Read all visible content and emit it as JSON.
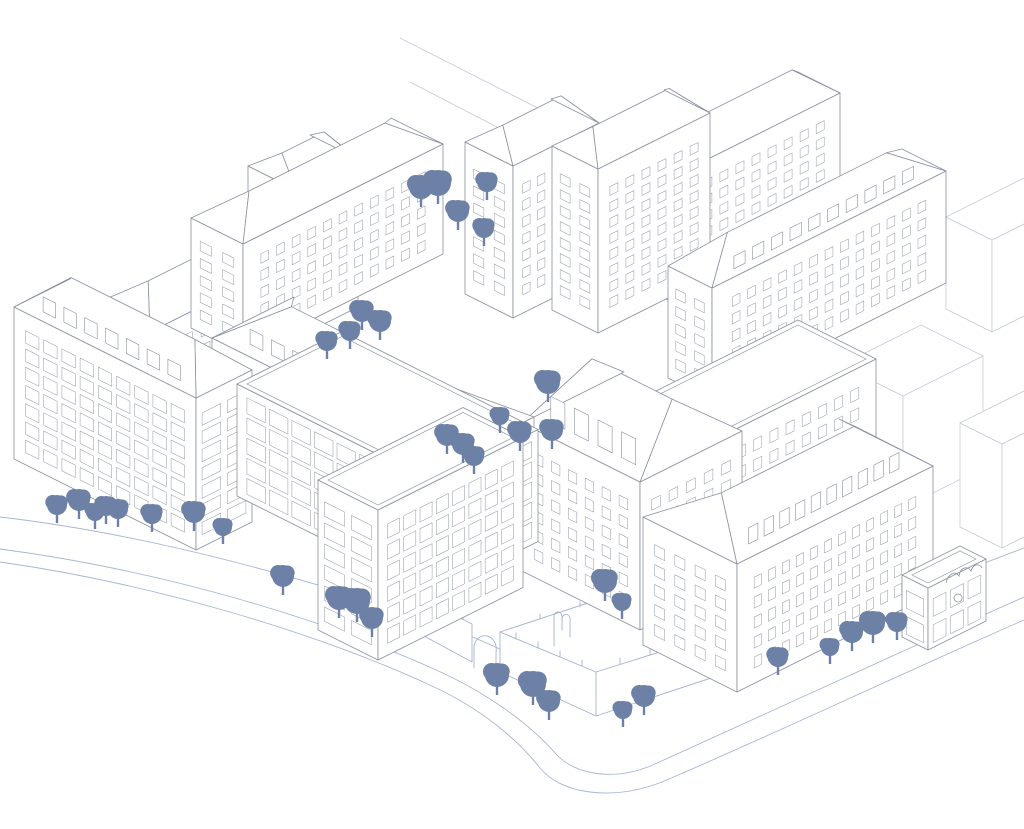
{
  "illustration": {
    "type": "axonometric-line-drawing",
    "subject": "urban block massing illustration with buildings, ruin walls, streets and trees",
    "background": "#ffffff"
  },
  "colors": {
    "line": "#8a90a0",
    "window": "#9aa0ad",
    "ghost": "#c7cdd9",
    "road": "#a9b5d6",
    "ruin": "#a4b1d3",
    "tree": "#6d80a6",
    "fill": "#ffffff"
  },
  "scene": {
    "context_lines": [
      "M 400,38 L 585,132",
      "M 410,82 L 522,140"
    ],
    "roads": [
      "M 0,517 C 130,532 270,568 405,612 C 450,627 492,644 526,662",
      "M 526,662 C 560,681 600,700 640,694 L 1024,548",
      "M 0,549 C 160,570 320,618 434,669 C 486,692 530,724 556,754 C 575,775 615,782 655,764 C 760,716 900,652 1024,597",
      "M 0,562 C 162,585 324,636 432,686 C 482,709 518,740 540,768 C 560,793 610,802 662,782 C 770,736 905,672 1024,620"
    ],
    "ruin": {
      "walls": [
        "424,600 472,624 472,662 424,636",
        "500,632 596,672 790,611 790,652 596,716 500,672"
      ],
      "lines": [
        "M 596,672 L 596,716",
        "M 500,632 L 694,568 L 790,611",
        "M 474,668 L 474,646 A 11,13 0 0 1 496,652 L 496,678",
        "M 554,646 L 554,616 a 4,5 0 0 1 8,2 l 0,12 m 0,-12 a 4,5 0 0 1 8,3 l 0,16",
        "M 433,604 l 0,-5 M 443,609 l 0,-5 M 453,614 l 0,-5 M 463,619 l 0,-5 M 516,639 l 0,-6 M 538,648 l 0,-6 M 560,657 l 0,-6 M 582,666 l 0,-6 M 620,664 l 0,-6 M 650,655 l 0,-6 M 680,646 l 0,-6 M 710,636 l 0,-6 M 740,627 l 0,-6 M 770,617 l 0,-6 M 540,619 l 0,-5 M 580,607 l 0,-5 M 620,594 l 0,-5 M 660,582 l 0,-5 M 720,580 l 0,-5 M 752,594 l 0,-5"
      ]
    },
    "chapel_details": [
      "M 946,583 c 2,-9 9,-13 13,-7 c 1,-8 8,-11 12,-5 c 2,-7 8,-8 11,-3",
      "M 958,602 a 4,4 0 1 1 0.2,0"
    ],
    "ghost_buildings": [
      {
        "name": "context-block-northeast",
        "c": [
          992,
          332
        ],
        "a": 46,
        "b": 88,
        "h": 92,
        "roof": "flat"
      },
      {
        "name": "context-block-east-1",
        "c": [
          903,
          508
        ],
        "a": 62,
        "b": 80,
        "h": 112,
        "roof": "flat"
      },
      {
        "name": "context-block-east-2",
        "c": [
          1002,
          548
        ],
        "a": 42,
        "b": 110,
        "h": 104,
        "roof": "flat"
      }
    ],
    "buildings": [
      {
        "name": "north-back-block",
        "c": [
          672,
          302
        ],
        "a": 42,
        "b": 168,
        "h": 125,
        "roof": "hip",
        "rise": 26,
        "se": {
          "cols": 9,
          "rows": 6,
          "style": "punched"
        },
        "sw": {
          "cols": 2,
          "rows": 6,
          "style": "punched"
        }
      },
      {
        "name": "north-tower-west",
        "c": [
          513,
          318
        ],
        "a": 48,
        "b": 86,
        "h": 152,
        "roof": "hip",
        "rise": 22,
        "se": {
          "cols": 5,
          "rows": 7,
          "style": "punched"
        },
        "sw": {
          "cols": 2,
          "rows": 7,
          "style": "punched"
        }
      },
      {
        "name": "north-tower-east",
        "c": [
          598,
          333
        ],
        "a": 46,
        "b": 112,
        "h": 164,
        "roof": "hip",
        "rise": 22,
        "se": {
          "cols": 6,
          "rows": 8,
          "style": "punched"
        },
        "sw": {
          "cols": 2,
          "rows": 8,
          "style": "punched"
        }
      },
      {
        "name": "northeast-slab",
        "c": [
          712,
          400
        ],
        "a": 44,
        "b": 234,
        "h": 112,
        "roof": "hip",
        "rise": 26,
        "dormers": 10,
        "se": {
          "cols": 13,
          "rows": 5,
          "style": "punched"
        },
        "sw": {
          "cols": 2,
          "rows": 5,
          "style": "punched"
        }
      },
      {
        "name": "northwest-back-slab",
        "c": [
          150,
          452
        ],
        "a": 56,
        "b": 164,
        "h": 120,
        "roof": "hip",
        "rise": 24,
        "se": {
          "cols": 8,
          "rows": 5,
          "style": "punched"
        },
        "sw": {
          "cols": 2,
          "rows": 5,
          "style": "punched"
        }
      },
      {
        "name": "west-tower",
        "c": [
          296,
          338
        ],
        "a": 48,
        "b": 62,
        "h": 148,
        "roof": "hip",
        "rise": 20,
        "se": {
          "cols": 3,
          "rows": 7,
          "style": "punched"
        },
        "sw": {
          "cols": 2,
          "rows": 7,
          "style": "punched"
        }
      },
      {
        "name": "west-slab",
        "c": [
          243,
          354
        ],
        "a": 52,
        "b": 200,
        "h": 110,
        "roof": "hip",
        "rise": 24,
        "se": {
          "cols": 11,
          "rows": 5,
          "style": "punched"
        },
        "sw": {
          "cols": 2,
          "rows": 5,
          "style": "punched"
        }
      },
      {
        "name": "courtyard-block",
        "c": [
          688,
          558
        ],
        "a": 78,
        "b": 188,
        "h": 105,
        "roof": "flat",
        "se": {
          "cols": 10,
          "rows": 4,
          "style": "punched"
        },
        "sw": {
          "cols": 3,
          "rows": 4,
          "style": "punched"
        }
      },
      {
        "name": "center-hip-building",
        "c": [
          640,
          630
        ],
        "a": 118,
        "b": 102,
        "h": 148,
        "roof": "hip",
        "rise": 48,
        "dormers": 4,
        "sw": {
          "cols": 6,
          "rows": 6,
          "style": "punched"
        },
        "se": {
          "cols": 5,
          "rows": 6,
          "style": "punched"
        }
      },
      {
        "name": "classical-terrace",
        "c": [
          452,
          576
        ],
        "a": 240,
        "b": 82,
        "h": 118,
        "roof": "hip",
        "rise": 30,
        "dormers": 9,
        "sw": {
          "cols": 11,
          "rows": 6,
          "style": "punched"
        },
        "se": {
          "cols": 3,
          "rows": 6,
          "style": "punched"
        }
      },
      {
        "name": "southeast-building",
        "c": [
          737,
          692
        ],
        "a": 94,
        "b": 196,
        "h": 128,
        "roof": "hip",
        "rise": 32,
        "dormers": 10,
        "se": {
          "cols": 12,
          "rows": 5,
          "style": "punched"
        },
        "sw": {
          "cols": 4,
          "rows": 5,
          "style": "punched"
        }
      },
      {
        "name": "corner-chapel",
        "c": [
          928,
          650
        ],
        "a": 26,
        "b": 58,
        "h": 62,
        "roof": "flat",
        "se": {
          "cols": 3,
          "rows": 2,
          "style": "grid"
        },
        "sw": {
          "cols": 1,
          "rows": 2,
          "style": "grid"
        }
      },
      {
        "name": "west-corner-building",
        "c": [
          196,
          550
        ],
        "a": 182,
        "b": 56,
        "h": 152,
        "roof": "hip",
        "rise": 30,
        "dormers": 7,
        "sw": {
          "cols": 9,
          "rows": 7,
          "style": "grid"
        },
        "se": {
          "cols": 2,
          "rows": 7,
          "style": "grid"
        }
      },
      {
        "name": "modern-office-low",
        "c": [
          433,
          594
        ],
        "a": 196,
        "b": 105,
        "h": 112,
        "roof": "flat",
        "sw": {
          "cols": 8,
          "rows": 5,
          "style": "strip"
        },
        "se": {
          "cols": 4,
          "rows": 5,
          "style": "strip"
        }
      },
      {
        "name": "modern-office-tall",
        "c": [
          378,
          660
        ],
        "a": 60,
        "b": 145,
        "h": 150,
        "roof": "flat",
        "se": {
          "cols": 8,
          "rows": 6,
          "style": "grid"
        },
        "sw": {
          "cols": 2,
          "rows": 6,
          "style": "grid"
        }
      }
    ],
    "trees": [
      [
        421,
        187,
        12
      ],
      [
        438,
        183,
        13
      ],
      [
        487,
        182,
        10
      ],
      [
        458,
        211,
        11
      ],
      [
        484,
        228,
        10
      ],
      [
        362,
        311,
        11
      ],
      [
        380,
        321,
        11
      ],
      [
        350,
        331,
        10
      ],
      [
        327,
        341,
        10
      ],
      [
        548,
        382,
        12
      ],
      [
        520,
        432,
        11
      ],
      [
        552,
        430,
        11
      ],
      [
        500,
        416,
        9
      ],
      [
        447,
        435,
        11
      ],
      [
        463,
        444,
        11
      ],
      [
        474,
        456,
        10
      ],
      [
        57,
        505,
        10
      ],
      [
        79,
        500,
        11
      ],
      [
        95,
        512,
        9
      ],
      [
        106,
        506,
        10
      ],
      [
        118,
        509,
        10
      ],
      [
        152,
        514,
        10
      ],
      [
        194,
        512,
        11
      ],
      [
        223,
        527,
        9
      ],
      [
        283,
        576,
        11
      ],
      [
        339,
        598,
        12
      ],
      [
        357,
        601,
        13
      ],
      [
        372,
        618,
        11
      ],
      [
        497,
        675,
        12
      ],
      [
        533,
        684,
        13
      ],
      [
        549,
        701,
        11
      ],
      [
        623,
        710,
        9
      ],
      [
        644,
        696,
        11
      ],
      [
        605,
        581,
        12
      ],
      [
        622,
        602,
        9
      ],
      [
        778,
        657,
        10
      ],
      [
        830,
        647,
        9
      ],
      [
        852,
        632,
        11
      ],
      [
        873,
        623,
        12
      ],
      [
        897,
        622,
        10
      ]
    ]
  }
}
